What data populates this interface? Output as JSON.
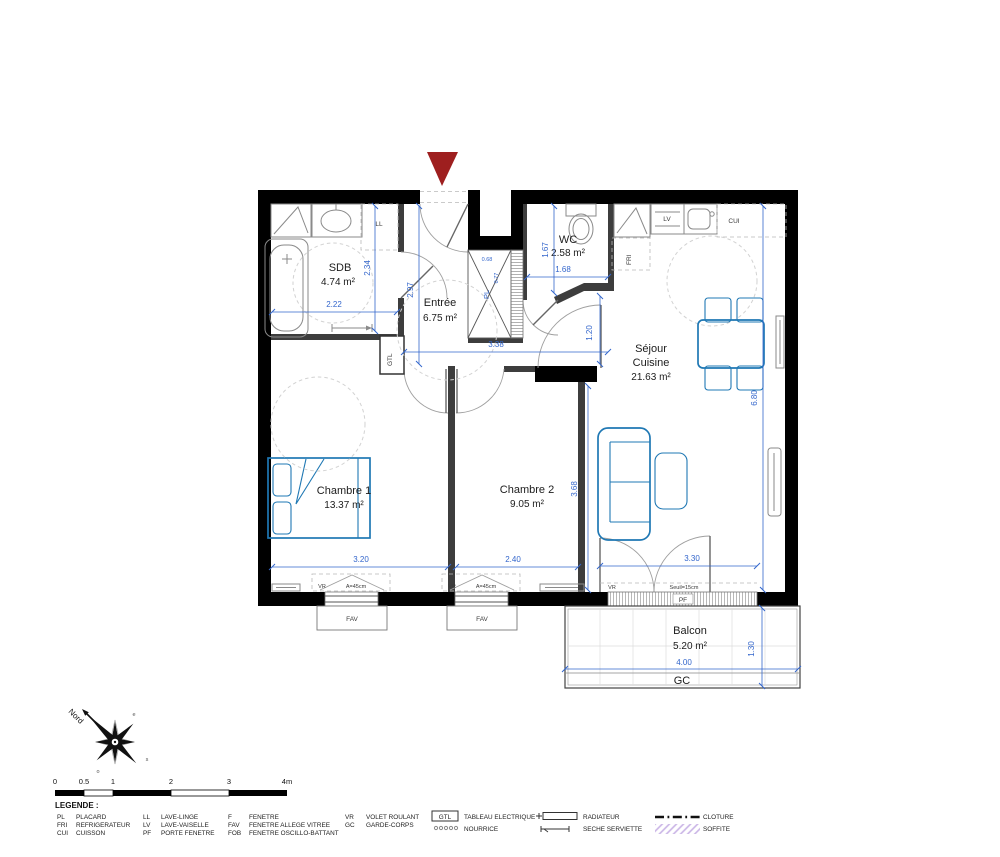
{
  "plan": {
    "rooms": {
      "sdb": {
        "name": "SDB",
        "area": "4.74 m²"
      },
      "wc": {
        "name": "WC",
        "area": "2.58 m²"
      },
      "entree": {
        "name": "Entrée",
        "area": "6.75 m²"
      },
      "sejour": {
        "line1": "Séjour",
        "line2": "Cuisine",
        "area": "21.63 m²"
      },
      "chambre1": {
        "name": "Chambre 1",
        "area": "13.37 m²"
      },
      "chambre2": {
        "name": "Chambre 2",
        "area": "9.05 m²"
      },
      "balcon": {
        "name": "Balcon",
        "area": "5.20 m²"
      }
    },
    "dims": {
      "sdb_w": "2.22",
      "sdb_h": "2.34",
      "entree_h": "2.97",
      "wc_h": "1.67",
      "wc_w": "1.68",
      "hall_w": "3.38",
      "hall_h": "1.20",
      "sejour_h": "6.80",
      "ch1_w": "3.20",
      "ch2_w": "2.40",
      "ch2_h": "3.68",
      "pf_w": "3.30",
      "balcon_w": "4.00",
      "balcon_h": "1.30",
      "pl_w": "0.68",
      "pl_h": "0.77"
    },
    "labels": {
      "ll": "LL",
      "lv": "LV",
      "cui": "CUI",
      "fri": "FRI",
      "pl": "PL",
      "gtl": "GTL",
      "vr": "VR",
      "fav": "FAV",
      "pf": "PF",
      "gc": "GC",
      "allege": "A=45cm",
      "seuil": "Seuil=15cm"
    }
  },
  "compass": {
    "north": "Nord",
    "east": "e",
    "south": "s",
    "west": "o"
  },
  "scalebar": {
    "ticks": [
      "0",
      "0.5",
      "1",
      "2",
      "3",
      "4m"
    ]
  },
  "legend": {
    "title": "LEGENDE :",
    "columns": [
      {
        "rows": [
          {
            "abbr": "PL",
            "label": "PLACARD"
          },
          {
            "abbr": "FRI",
            "label": "REFRIGERATEUR"
          },
          {
            "abbr": "CUI",
            "label": "CUISSON"
          }
        ]
      },
      {
        "rows": [
          {
            "abbr": "LL",
            "label": "LAVE-LINGE"
          },
          {
            "abbr": "LV",
            "label": "LAVE-VAISELLE"
          },
          {
            "abbr": "PF",
            "label": "PORTE FENETRE"
          }
        ]
      },
      {
        "rows": [
          {
            "abbr": "F",
            "label": "FENETRE"
          },
          {
            "abbr": "FAV",
            "label": "FENETRE ALLEGE VITREE"
          },
          {
            "abbr": "FOB",
            "label": "FENETRE OSCILLO-BATTANT"
          }
        ]
      },
      {
        "rows": [
          {
            "abbr": "VR",
            "label": "VOLET ROULANT"
          },
          {
            "abbr": "GC",
            "label": "GARDE-CORPS"
          }
        ]
      }
    ],
    "symbols": {
      "gtl_box": "GTL",
      "tableau": "TABLEAU ELECTRIQUE",
      "nourrice": "NOURRICE",
      "radiateur": "RADIATEUR",
      "seche": "SECHE SERVIETTE",
      "cloture": "CLOTURE",
      "soffite": "SOFFITE"
    }
  },
  "colors": {
    "dim_blue": "#3366cc",
    "furniture_blue": "#1f78b4",
    "wall_black": "#000000",
    "entrance_red": "#9e1f1f",
    "soffite_purple": "#c9b4e6"
  }
}
